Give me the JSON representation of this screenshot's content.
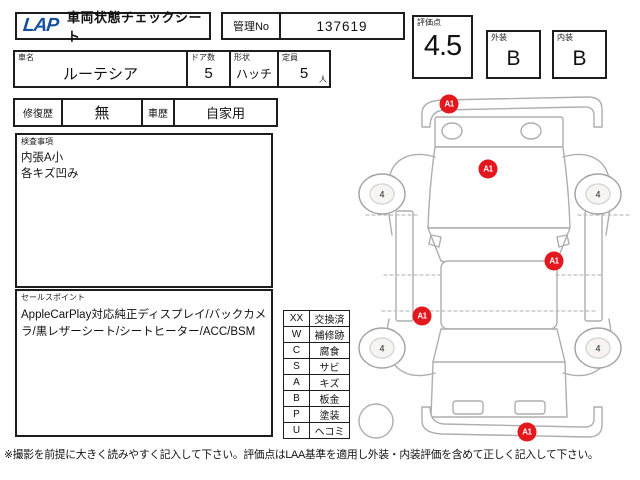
{
  "header": {
    "logo": "LAP",
    "title": "車両状態チェックシート",
    "control_no_label": "管理No",
    "control_no_value": "137619",
    "score_label": "評価点",
    "score_value": "4.5",
    "exterior_label": "外装",
    "exterior_value": "B",
    "interior_label": "内装",
    "interior_value": "B"
  },
  "vehicle": {
    "name_label": "車名",
    "name_value": "ルーテシア",
    "doors_label": "ドア数",
    "doors_value": "5",
    "shape_label": "形状",
    "shape_value": "ハッチ",
    "capacity_label": "定員",
    "capacity_value": "5",
    "capacity_unit": "人"
  },
  "history": {
    "repair_label": "修復歴",
    "repair_value": "無",
    "usage_label": "車歴",
    "usage_value": "自家用"
  },
  "inspection": {
    "label": "検査事項",
    "lines": [
      "内張A小",
      "各キズ凹み"
    ]
  },
  "sales_points": {
    "label": "セールスポイント",
    "text": "AppleCarPlay対応純正ディスプレイ/バックカメラ/黒レザーシート/シートヒーター/ACC/BSM"
  },
  "legend": {
    "rows": [
      {
        "code": "XX",
        "meaning": "交換済"
      },
      {
        "code": "W",
        "meaning": "補修跡"
      },
      {
        "code": "C",
        "meaning": "腐食"
      },
      {
        "code": "S",
        "meaning": "サビ"
      },
      {
        "code": "A",
        "meaning": "キズ"
      },
      {
        "code": "B",
        "meaning": "板金"
      },
      {
        "code": "P",
        "meaning": "塗装"
      },
      {
        "code": "U",
        "meaning": "ヘコミ"
      }
    ]
  },
  "diagram": {
    "damage_markers": [
      {
        "label": "A1",
        "x": 32.3,
        "y": 5.3,
        "location": "front-bumper"
      },
      {
        "label": "A1",
        "x": 46.1,
        "y": 23.3,
        "location": "hood"
      },
      {
        "label": "A1",
        "x": 69.5,
        "y": 48.9,
        "location": "right-side"
      },
      {
        "label": "A1",
        "x": 22.7,
        "y": 64.2,
        "location": "left-side"
      },
      {
        "label": "A1",
        "x": 59.9,
        "y": 96.4,
        "location": "rear-bumper"
      }
    ],
    "tire_markers": [
      {
        "label": "4",
        "x": 8.5,
        "y": 30.3,
        "location": "front-left-wheel"
      },
      {
        "label": "4",
        "x": 85.1,
        "y": 30.3,
        "location": "front-right-wheel"
      },
      {
        "label": "4",
        "x": 8.5,
        "y": 73.1,
        "location": "rear-left-wheel"
      },
      {
        "label": "4",
        "x": 85.1,
        "y": 73.1,
        "location": "rear-right-wheel"
      }
    ]
  },
  "footer": {
    "note": "※撮影を前提に大きく読みやすく記入して下さい。評価点はLAA基準を適用し外装・内装評価を含めて正しく記入して下さい。"
  },
  "colors": {
    "marker_red": "#e3171e",
    "logo_blue": "#17509e",
    "border_dark": "#1d1d1d",
    "outline_gray": "#aeaeae"
  }
}
